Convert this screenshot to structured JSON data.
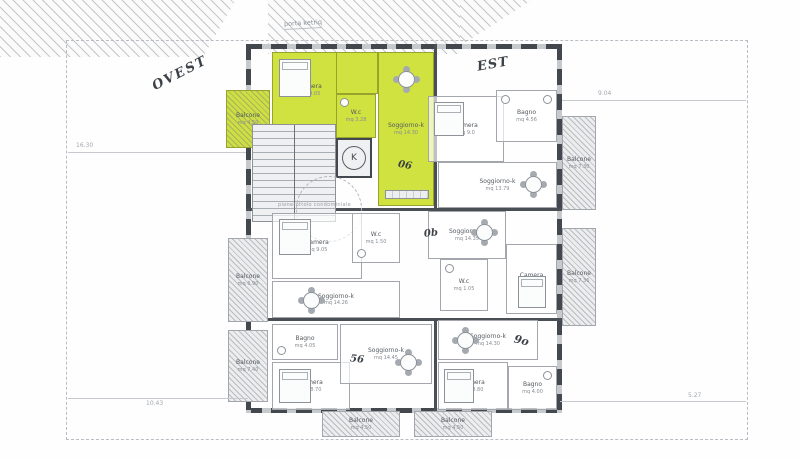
{
  "site": {
    "note": "porta ketriq",
    "west": "OVEST",
    "east": "EST"
  },
  "core": {
    "elevator": "K",
    "corridor": "pianerottolo condominiale"
  },
  "dims": {
    "left": "16.30",
    "top_right": "9.04",
    "bottom_left": "10.43",
    "bottom_right": "5.27"
  },
  "annotations": {
    "a1": "06",
    "a2": "0b",
    "a3": "56",
    "a4": "9o"
  },
  "apartments": {
    "highlighted": {
      "balcone": {
        "name": "Balcone",
        "area": "mq 4.50"
      },
      "camera": {
        "name": "Camera",
        "area": "mq 9.05"
      },
      "wc": {
        "name": "W.c",
        "area": "mq 3.28"
      },
      "soggiorno": {
        "name": "Soggiorno-k",
        "area": "mq 14.30"
      }
    },
    "top_right": {
      "camera": {
        "name": "Camera",
        "area": "mq 9.0"
      },
      "bagno": {
        "name": "Bagno",
        "area": "mq 4.56"
      },
      "soggiorno": {
        "name": "Soggiorno-k",
        "area": "mq 13.79"
      },
      "balcone": {
        "name": "Balcone",
        "area": "mq 7.30"
      }
    },
    "mid_left": {
      "camera": {
        "name": "Camera",
        "area": "mq 9.05"
      },
      "wc": {
        "name": "W.c",
        "area": "mq 1.50"
      },
      "soggiorno": {
        "name": "Soggiorno-k",
        "area": "mq 14.26"
      },
      "balcone": {
        "name": "Balcone",
        "area": "mq 6.90"
      }
    },
    "mid_right": {
      "soggiorno": {
        "name": "Soggiorno-k",
        "area": "mq 14.35"
      },
      "wc": {
        "name": "W.c",
        "area": "mq 1.05"
      },
      "camera": {
        "name": "Camera",
        "area": "mq 9.10"
      },
      "balcone": {
        "name": "Balcone",
        "area": "mq 7.36"
      }
    },
    "bottom_left": {
      "bagno": {
        "name": "Bagno",
        "area": "mq 4.05"
      },
      "camera": {
        "name": "Camera",
        "area": "mq 8.70"
      },
      "soggiorno": {
        "name": "Soggiorno-k",
        "area": "mq 14.45"
      },
      "balcone_side": {
        "name": "Balcone",
        "area": "mq 7.40"
      },
      "balcone_bottom": {
        "name": "Balcone",
        "area": "mq 4.50"
      }
    },
    "bottom_right": {
      "soggiorno": {
        "name": "Soggiorno-k",
        "area": "mq 14.30"
      },
      "camera": {
        "name": "Camera",
        "area": "mq 8.80"
      },
      "bagno": {
        "name": "Bagno",
        "area": "mq 4.00"
      },
      "balcone_bottom": {
        "name": "Balcone",
        "area": "mq 4.50"
      }
    }
  },
  "colors": {
    "highlight": "#d0e23f",
    "wall": "#43484e",
    "hatch_line": "#82878c"
  }
}
